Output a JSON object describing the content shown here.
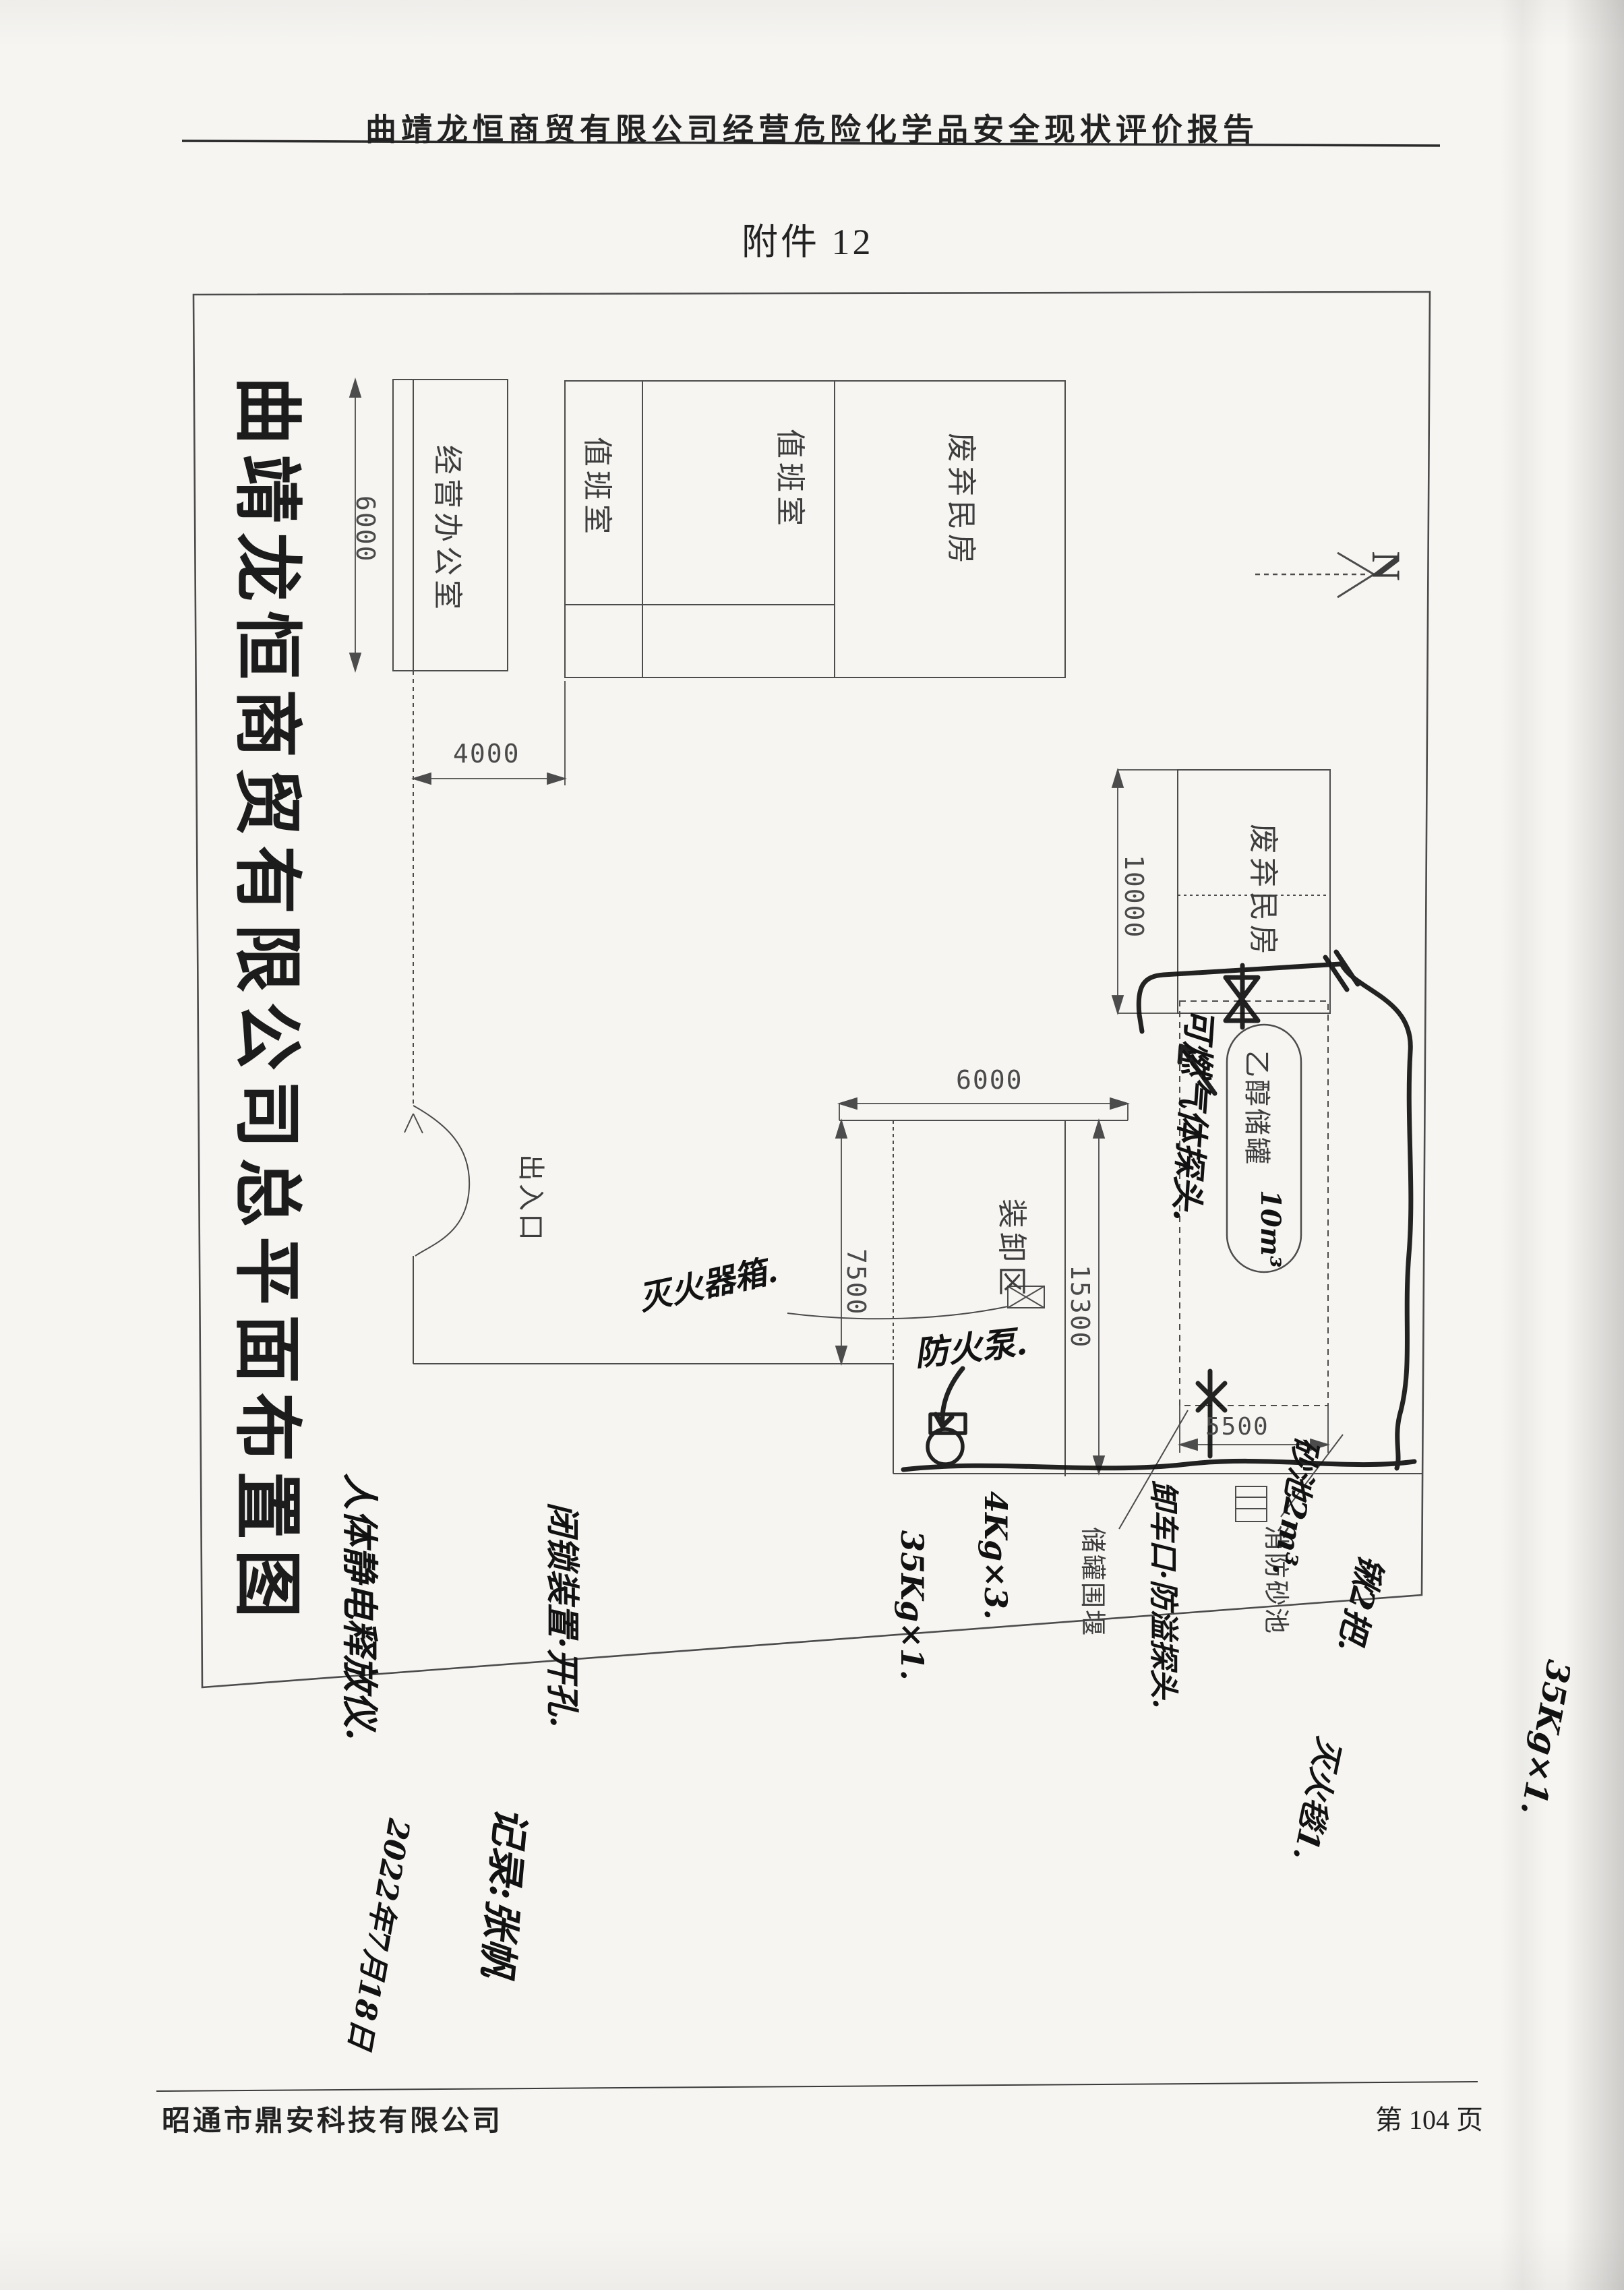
{
  "page": {
    "header_title": "曲靖龙恒商贸有限公司经营危险化学品安全现状评价报告",
    "attachment_label": "附件 12",
    "footer_company": "昭通市鼎安科技有限公司",
    "page_number": "第 104 页"
  },
  "drawing": {
    "title": "曲靖龙恒商贸有限公司总平面布置图",
    "north_label": "N",
    "labels": {
      "office": "经营办公室",
      "duty_room_1": "值班室",
      "duty_room_2": "值班室",
      "abandoned_house_top": "废弃民房",
      "abandoned_house_right": "废弃民房",
      "entrance": "出入口",
      "loading_area": "装卸区",
      "ethanol_tank": "乙醇储罐",
      "tank_bund": "储罐围堰",
      "fire_sand_pool": "消防砂池"
    },
    "dimensions": {
      "office_height": "6000",
      "office_offset": "4000",
      "abandoned_width": "10000",
      "loading_width": "6000",
      "loading_height": "7500",
      "site_depth": "15300",
      "bund_width": "5500"
    }
  },
  "handwritten": {
    "tank_capacity": "10m³",
    "gas_detector": "可燃气体探头.",
    "pump": "防火泵.",
    "extinguisher_box": "灭火器箱.",
    "unloading_point": "卸车口·防溢探头.",
    "sand_pool_volume": "砂池2m³.",
    "extinguisher_4kg": "4Kg×3.",
    "extinguisher_35kg": "35Kg×1.",
    "shovels": "锹2把.",
    "extinguisher_35kg_margin": "35Kg×1.",
    "fire_blanket": "灭火毯1.",
    "interlock_note": "闭锁装置·开孔.",
    "static_discharger": "人体静电释放仪.",
    "recorder": "记录:张帆",
    "date": "2022年7月18日"
  },
  "symbols": {
    "north_arrow": "north-arrow",
    "tank_top_valve": "valve-bowtie",
    "pump_symbol": "pump-circle",
    "extinguisher_box_symbol": "box-with-x",
    "sand_pool_symbol": "hatched-box",
    "gate_symbol": "s-curve-gate"
  }
}
